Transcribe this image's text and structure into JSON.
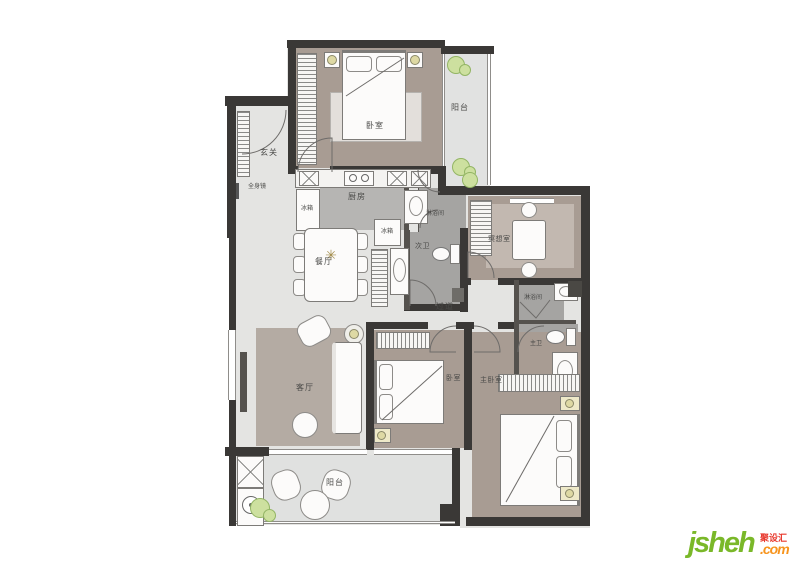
{
  "plan": {
    "bedroom_top": "卧室",
    "balcony_top": "阳台",
    "entry": "玄关",
    "mirror_note": "全身镜",
    "kitchen": "厨房",
    "fridge_a": "冰箱",
    "fridge_b": "冰箱",
    "dining": "餐厅",
    "shower_a": "淋浴间",
    "bath_second": "次卫",
    "corridor": "过道",
    "meditation": "冥想室",
    "shower_b": "淋浴间",
    "bath_master": "主卫",
    "living": "客厅",
    "bedroom_second": "卧室",
    "bedroom_master": "主卧室",
    "balcony_bottom": "阳台"
  },
  "logo": {
    "brand": "jsheh",
    "badge": "聚设汇",
    "tld": ".com"
  },
  "colors": {
    "wall": "#3a3836",
    "floor": "#e4e4e2",
    "taupe": "#a89c93",
    "rugdark": "#b4aba3",
    "bath": "#a5a4a2",
    "kitchen": "#b6b5b3",
    "plant": "#cde09f",
    "accent_green": "#7ab829",
    "accent_orange": "#f7941d",
    "accent_red": "#e8392e"
  }
}
